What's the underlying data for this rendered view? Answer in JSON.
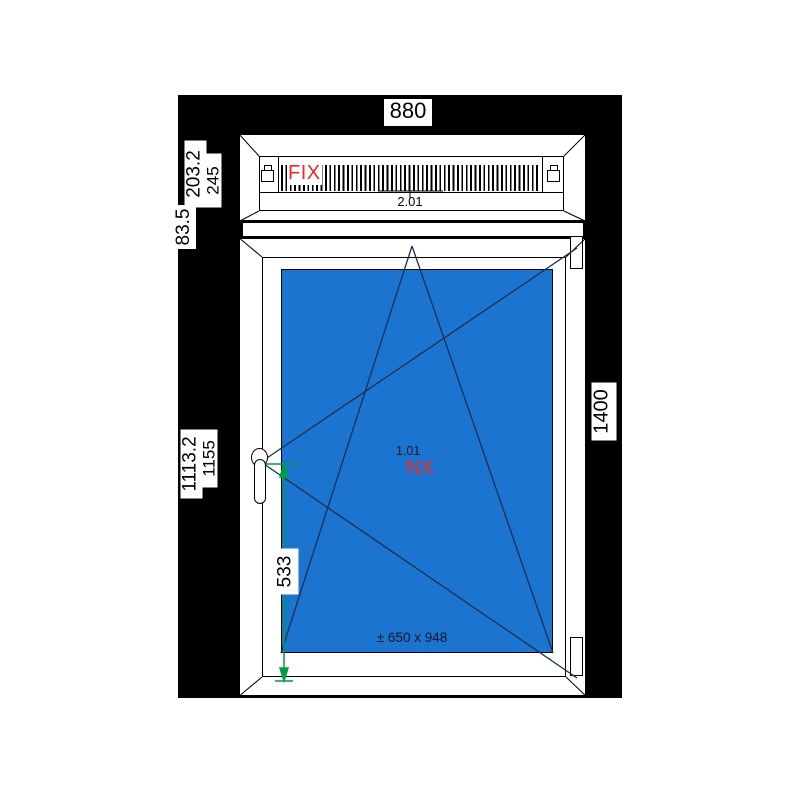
{
  "canvas": {
    "page_background": "#ffffff",
    "drawing_area_background": "#000000"
  },
  "colors": {
    "glass_blue": "#1b75d0",
    "accent_red": "#ee2b23",
    "dimension_green": "#009c46",
    "outline_black": "#000000",
    "opening_line_navy": "#1a2e52"
  },
  "dimensions": {
    "total_width": "880",
    "main_height": "1400",
    "top_glass_height": "203.2",
    "top_frame_height": "245",
    "top_offset": "83.5",
    "main_glass_height": "1113.2",
    "main_sash_height": "1155",
    "handle_height": "533"
  },
  "top_light": {
    "type_label": "FIX",
    "position_number": "2.01"
  },
  "main_sash": {
    "position_number": "1.01",
    "profile_label": "NX",
    "size_note": "± 650 x 948"
  }
}
